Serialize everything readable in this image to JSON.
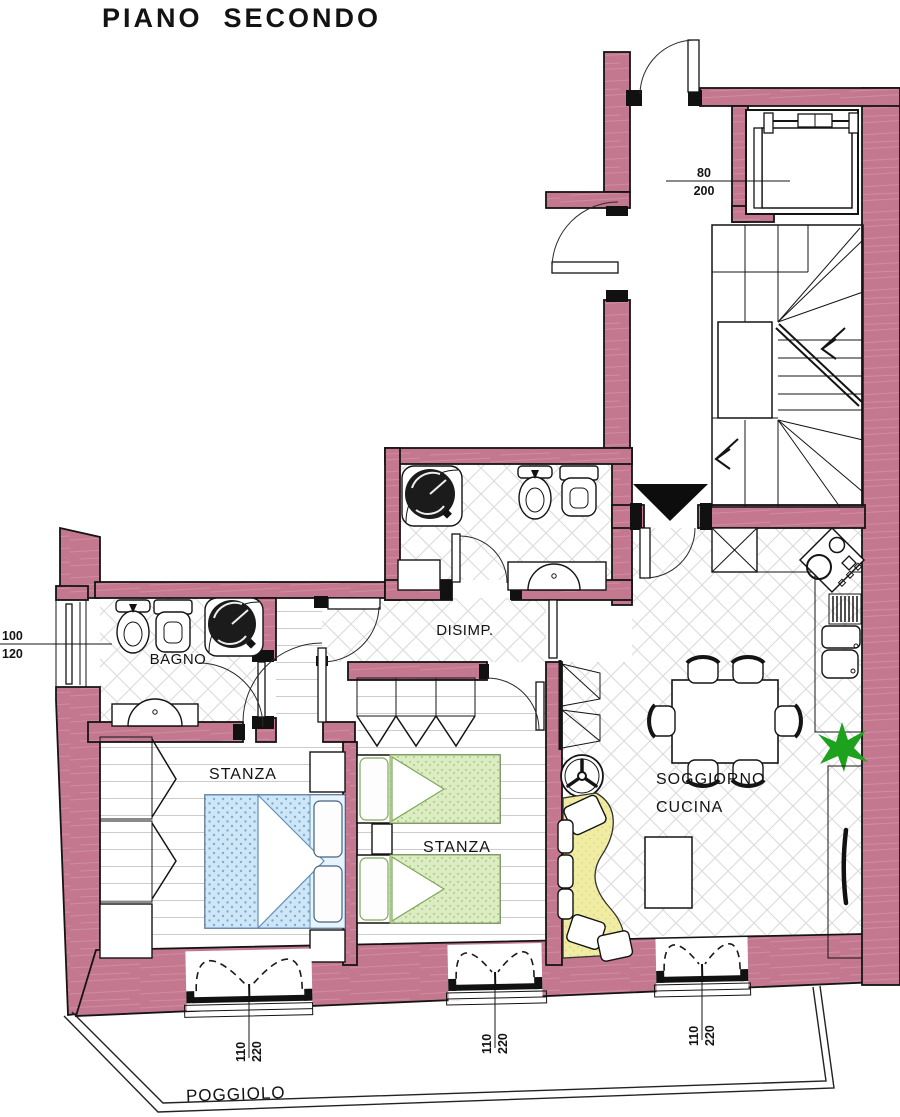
{
  "title": "PIANO  SECONDO",
  "rooms": {
    "bagno": "BAGNO",
    "disimpegno": "DISIMP.",
    "stanza_1": "STANZA",
    "stanza_2": "STANZA",
    "soggiorno_line_1": "SOGGIORNO",
    "soggiorno_line_2": "CUCINA",
    "poggiolo": "POGGIOLO"
  },
  "dimensions": {
    "bagno_window": {
      "width": "100",
      "height": "120"
    },
    "stairwell_door": {
      "width": "80",
      "height": "200"
    },
    "balcony_door_1": {
      "width": "110",
      "height": "220"
    },
    "balcony_door_2": {
      "width": "110",
      "height": "220"
    },
    "balcony_door_3": {
      "width": "110",
      "height": "220"
    }
  },
  "colors": {
    "wall_fill": "#c4788f",
    "wall_streak": "#d897aa",
    "outline": "#141414",
    "bed_blue": "#cfe6f7",
    "bed_blue_dot": "#79aed6",
    "bed_green": "#dcedc4",
    "bed_green_dot": "#9cc068",
    "sofa_yellow": "#f1eca3",
    "sofa_dot": "#d8d06d",
    "plant_green": "#1ea21e",
    "counter_bg": "#fcfbef",
    "counter_dot": "#c9c27a",
    "floor_line": "#cccccc",
    "tile_line": "#d9d9d9"
  },
  "symbols": {
    "entrance_marker": "entrance-arrow-icon",
    "stairs": "staircase-icon",
    "lift": "elevator-icon",
    "shower": "shower-icon",
    "toilet": "toilet-icon",
    "bidet": "bidet-icon",
    "washbasin": "washbasin-icon",
    "double_bed": "double-bed-icon",
    "single_bed": "single-bed-icon",
    "wardrobe": "wardrobe-icon",
    "dining_table": "dining-table-icon",
    "chair": "chair-icon",
    "sofa": "sofa-icon",
    "plant": "plant-icon",
    "cooktop": "cooktop-icon",
    "kitchen_sink": "kitchen-sink-icon",
    "french_door": "french-door",
    "window": "window"
  }
}
